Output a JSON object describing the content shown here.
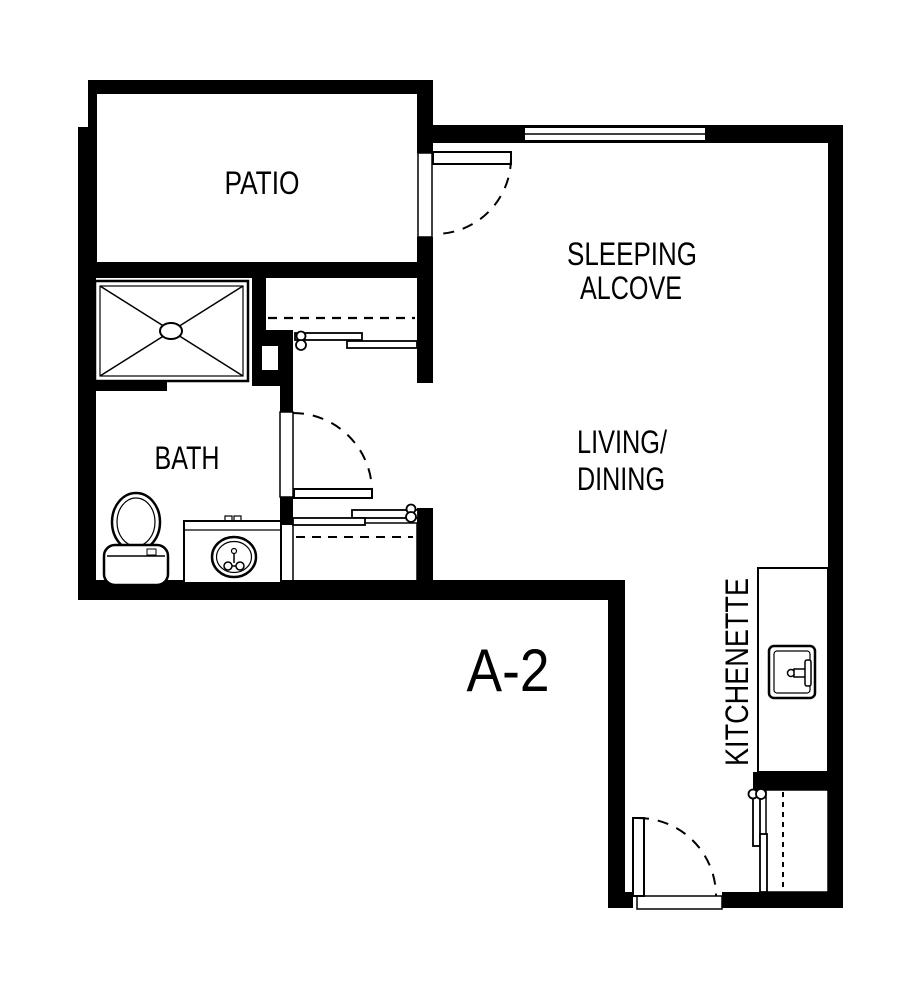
{
  "floor_plan": {
    "unit_label": "A-2",
    "labels": {
      "patio": "PATIO",
      "sleeping_alcove": [
        "SLEEPING",
        "ALCOVE"
      ],
      "living_dining": [
        "LIVING/",
        "DINING"
      ],
      "bath": "BATH",
      "kitchenette": "KITCHENETTE"
    },
    "colors": {
      "wall": "#000000",
      "background": "#ffffff"
    },
    "fixtures": [
      "shower-fixture",
      "toilet-fixture",
      "vanity-sink-fixture",
      "kitchen-sink-fixture",
      "upper-closet-sliding-doors",
      "lower-closet-sliding-doors",
      "entry-closet-sliding-doors"
    ],
    "doors": [
      "patio-door",
      "bath-door",
      "entry-door"
    ],
    "windows": [
      "alcove-window"
    ]
  }
}
